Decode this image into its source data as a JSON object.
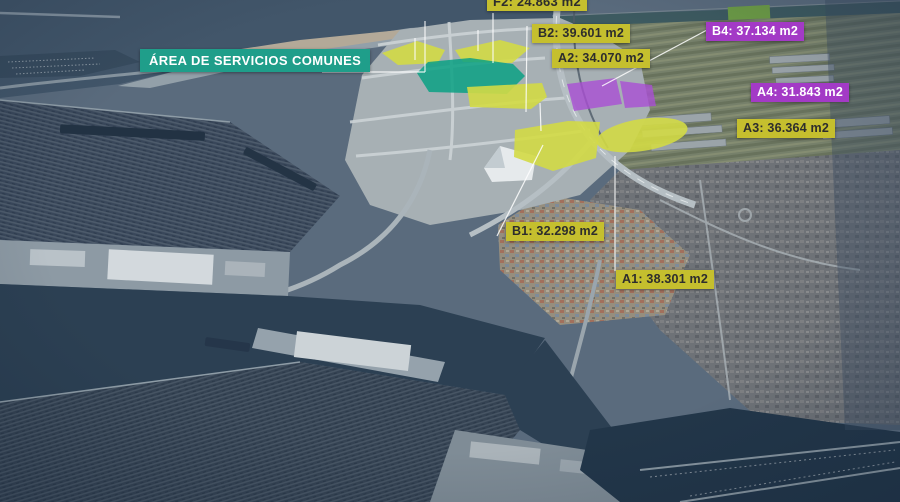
{
  "annotations": {
    "zone_label": {
      "text": "ÁREA DE SERVICIOS COMUNES"
    },
    "parcels": [
      {
        "id": "F2",
        "label": "F2: 24.863 m2",
        "area_m2": "24.863",
        "color_key": "yellow"
      },
      {
        "id": "B2",
        "label": "B2: 39.601 m2",
        "area_m2": "39.601",
        "color_key": "yellow"
      },
      {
        "id": "A2",
        "label": "A2: 34.070 m2",
        "area_m2": "34.070",
        "color_key": "yellow"
      },
      {
        "id": "B4",
        "label": "B4: 37.134 m2",
        "area_m2": "37.134",
        "color_key": "purple"
      },
      {
        "id": "A4",
        "label": "A4: 31.843 m2",
        "area_m2": "31.843",
        "color_key": "purple"
      },
      {
        "id": "A3",
        "label": "A3: 36.364 m2",
        "area_m2": "36.364",
        "color_key": "yellow"
      },
      {
        "id": "B1",
        "label": "B1: 32.298 m2",
        "area_m2": "32.298",
        "color_key": "yellow"
      },
      {
        "id": "A1",
        "label": "A1: 38.301 m2",
        "area_m2": "38.301",
        "color_key": "yellow"
      }
    ],
    "units": "m2",
    "colors": {
      "yellow_label": "#c5bf2e",
      "teal_label": "#1f9e8a",
      "purple_label": "#a33ac6",
      "yellow_parcel": "#d3da45",
      "teal_parcel": "#0aa184",
      "purple_parcel": "#aa4fd4",
      "leader_line": "#ffffff"
    }
  }
}
